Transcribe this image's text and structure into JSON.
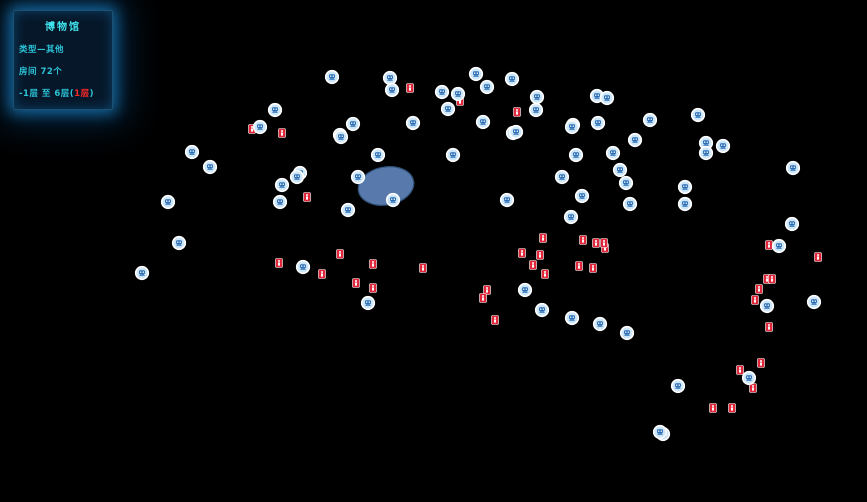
{
  "panel": {
    "title": "博物馆",
    "type_line": "类型—其他",
    "rooms_line": "房间 72个",
    "floor_prefix": "-1层 至 6层(",
    "floor_current": "1层",
    "floor_suffix": ")"
  },
  "colors": {
    "background": "#000000",
    "accent_cyan": "#3fe3ee",
    "text_cyan": "#2cc3d6",
    "text_red": "#ff2828",
    "wall_top": "#e4ebee",
    "wall_side": "#aebfc8",
    "wall_side_dark": "#8ba0ab",
    "wall_edge": "#9cb1bb",
    "floor_lavender": "#c4cae9",
    "floor_white": "#f3f7f9",
    "door_brown": "#7c4a1f",
    "door_top": "#96612c",
    "camera_ring": "#ffffff",
    "camera_fill": "#cde7f8",
    "camera_glyph": "#2b6db4",
    "exit_red": "#e2273a",
    "blob_blue": "#5d80b5",
    "blob_dark": "#33567f",
    "highlight_pink": "#ff7ab8"
  },
  "scene": {
    "ground_anchors": [
      [
        228,
        96
      ],
      [
        597,
        31
      ],
      [
        100,
        330
      ],
      [
        795,
        480
      ]
    ],
    "roof_anchors": [
      [
        228,
        87
      ],
      [
        597,
        23
      ],
      [
        100,
        306
      ],
      [
        795,
        456
      ]
    ],
    "wall_thickness": 9,
    "door_thickness": 10.5,
    "blob": {
      "cx": 386,
      "cy": 186,
      "rx": 28,
      "ry": 19,
      "rot": -10,
      "key": 195
    },
    "floors": [
      [
        120,
        0,
        150,
        80,
        "L"
      ],
      [
        270,
        0,
        120,
        80,
        "W"
      ],
      [
        390,
        0,
        110,
        80,
        "L"
      ],
      [
        500,
        0,
        140,
        80,
        "L"
      ],
      [
        640,
        0,
        120,
        90,
        "L"
      ],
      [
        60,
        90,
        120,
        85,
        "L"
      ],
      [
        190,
        80,
        120,
        95,
        "L"
      ],
      [
        320,
        80,
        130,
        95,
        "L"
      ],
      [
        460,
        80,
        100,
        95,
        "W"
      ],
      [
        570,
        90,
        90,
        85,
        "L"
      ],
      [
        660,
        100,
        100,
        80,
        "W"
      ],
      [
        -50,
        140,
        110,
        115,
        "L"
      ],
      [
        110,
        180,
        110,
        115,
        "L"
      ],
      [
        230,
        180,
        120,
        115,
        "W"
      ],
      [
        360,
        185,
        110,
        110,
        "L"
      ],
      [
        480,
        180,
        90,
        115,
        "L"
      ],
      [
        580,
        180,
        100,
        115,
        "W"
      ],
      [
        690,
        185,
        110,
        110,
        "L"
      ],
      [
        -70,
        255,
        110,
        110,
        "L"
      ],
      [
        -60,
        390,
        125,
        95,
        "L"
      ],
      [
        -40,
        300,
        690,
        42,
        "W"
      ],
      [
        240,
        348,
        130,
        105,
        "W"
      ],
      [
        380,
        348,
        120,
        105,
        "L"
      ],
      [
        510,
        348,
        110,
        105,
        "L"
      ],
      [
        240,
        460,
        245,
        95,
        "L"
      ],
      [
        490,
        460,
        190,
        95,
        "L"
      ],
      [
        560,
        558,
        90,
        42,
        "W"
      ],
      [
        700,
        60,
        85,
        480,
        "W"
      ],
      [
        785,
        100,
        120,
        90,
        "L"
      ],
      [
        785,
        200,
        120,
        90,
        "W"
      ],
      [
        785,
        300,
        120,
        90,
        "L"
      ],
      [
        785,
        400,
        100,
        85,
        "L"
      ]
    ],
    "doors": [
      [
        160,
        80,
        182,
        80
      ],
      [
        220,
        80,
        242,
        80
      ],
      [
        350,
        80,
        372,
        80
      ],
      [
        340,
        175,
        362,
        175
      ],
      [
        600,
        175,
        622,
        175
      ],
      [
        680,
        90,
        702,
        90
      ],
      [
        140,
        180,
        162,
        180
      ],
      [
        260,
        180,
        282,
        180
      ],
      [
        395,
        185,
        417,
        185
      ],
      [
        500,
        180,
        522,
        180
      ],
      [
        600,
        180,
        622,
        180
      ],
      [
        720,
        185,
        742,
        185
      ],
      [
        60,
        180,
        60,
        202
      ],
      [
        110,
        210,
        110,
        232
      ],
      [
        300,
        300,
        322,
        300
      ],
      [
        450,
        300,
        472,
        300
      ],
      [
        560,
        300,
        582,
        300
      ],
      [
        280,
        348,
        302,
        348
      ],
      [
        420,
        348,
        442,
        348
      ],
      [
        540,
        348,
        562,
        348
      ],
      [
        380,
        380,
        380,
        402
      ],
      [
        340,
        460,
        362,
        460
      ],
      [
        560,
        460,
        582,
        460
      ],
      [
        700,
        200,
        700,
        222
      ],
      [
        700,
        320,
        700,
        342
      ],
      [
        700,
        430,
        700,
        452
      ]
    ],
    "pink_edges": [
      [
        -60,
        485,
        65,
        485
      ],
      [
        240,
        555,
        485,
        555
      ],
      [
        490,
        555,
        680,
        555
      ]
    ]
  },
  "markers": {
    "cameras": [
      [
        332,
        77
      ],
      [
        390,
        78
      ],
      [
        392,
        90
      ],
      [
        442,
        92
      ],
      [
        458,
        94
      ],
      [
        476,
        74
      ],
      [
        487,
        87
      ],
      [
        512,
        79
      ],
      [
        448,
        109
      ],
      [
        537,
        97
      ],
      [
        536,
        110
      ],
      [
        597,
        96
      ],
      [
        607,
        98
      ],
      [
        573,
        125
      ],
      [
        598,
        123
      ],
      [
        513,
        133
      ],
      [
        413,
        123
      ],
      [
        353,
        124
      ],
      [
        340,
        135
      ],
      [
        275,
        110
      ],
      [
        260,
        127
      ],
      [
        192,
        152
      ],
      [
        210,
        167
      ],
      [
        300,
        173
      ],
      [
        282,
        185
      ],
      [
        297,
        177
      ],
      [
        280,
        202
      ],
      [
        168,
        202
      ],
      [
        179,
        243
      ],
      [
        341,
        137
      ],
      [
        378,
        155
      ],
      [
        358,
        177
      ],
      [
        393,
        200
      ],
      [
        348,
        210
      ],
      [
        453,
        155
      ],
      [
        483,
        122
      ],
      [
        516,
        132
      ],
      [
        507,
        200
      ],
      [
        650,
        120
      ],
      [
        698,
        115
      ],
      [
        572,
        127
      ],
      [
        635,
        140
      ],
      [
        706,
        143
      ],
      [
        723,
        146
      ],
      [
        576,
        155
      ],
      [
        562,
        177
      ],
      [
        613,
        153
      ],
      [
        620,
        170
      ],
      [
        626,
        183
      ],
      [
        582,
        196
      ],
      [
        571,
        217
      ],
      [
        630,
        204
      ],
      [
        685,
        187
      ],
      [
        685,
        204
      ],
      [
        793,
        168
      ],
      [
        792,
        224
      ],
      [
        779,
        246
      ],
      [
        572,
        318
      ],
      [
        600,
        324
      ],
      [
        627,
        333
      ],
      [
        678,
        386
      ],
      [
        663,
        434
      ],
      [
        749,
        378
      ],
      [
        767,
        306
      ],
      [
        814,
        302
      ],
      [
        303,
        267
      ],
      [
        368,
        303
      ],
      [
        525,
        290
      ],
      [
        542,
        310
      ],
      [
        706,
        153
      ],
      [
        142,
        273
      ],
      [
        660,
        432
      ]
    ],
    "exits": [
      [
        410,
        88
      ],
      [
        460,
        101
      ],
      [
        517,
        112
      ],
      [
        483,
        123
      ],
      [
        282,
        133
      ],
      [
        252,
        129
      ],
      [
        307,
        197
      ],
      [
        279,
        263
      ],
      [
        322,
        274
      ],
      [
        340,
        254
      ],
      [
        373,
        264
      ],
      [
        356,
        283
      ],
      [
        373,
        288
      ],
      [
        423,
        268
      ],
      [
        487,
        290
      ],
      [
        483,
        298
      ],
      [
        495,
        320
      ],
      [
        522,
        253
      ],
      [
        533,
        265
      ],
      [
        540,
        255
      ],
      [
        543,
        238
      ],
      [
        583,
        240
      ],
      [
        605,
        248
      ],
      [
        579,
        266
      ],
      [
        593,
        268
      ],
      [
        545,
        274
      ],
      [
        596,
        243
      ],
      [
        604,
        243
      ],
      [
        740,
        370
      ],
      [
        761,
        363
      ],
      [
        753,
        388
      ],
      [
        713,
        408
      ],
      [
        732,
        408
      ],
      [
        769,
        245
      ],
      [
        818,
        257
      ],
      [
        767,
        279
      ],
      [
        772,
        279
      ],
      [
        759,
        289
      ],
      [
        755,
        300
      ],
      [
        769,
        327
      ]
    ]
  }
}
